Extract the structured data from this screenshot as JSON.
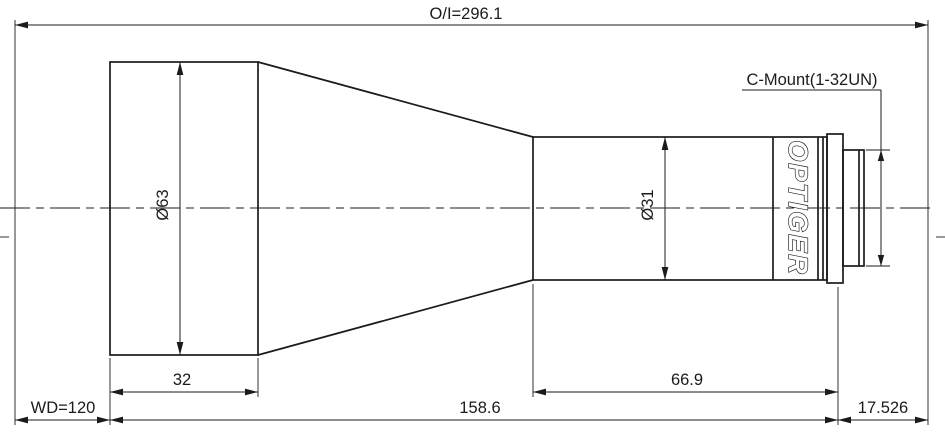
{
  "annotations": {
    "overall_object_image": "O/I=296.1",
    "c_mount": "C-Mount(1-32UN)",
    "brand": "OPTIGER",
    "front_diameter": "Ø63",
    "barrel_diameter": "Ø31",
    "front_length": "32",
    "working_distance": "WD=120",
    "mid_length": "158.6",
    "barrel_length": "66.9",
    "flange_distance": "17.526"
  },
  "colors": {
    "line": "#1b1b1b",
    "background": "#ffffff"
  }
}
